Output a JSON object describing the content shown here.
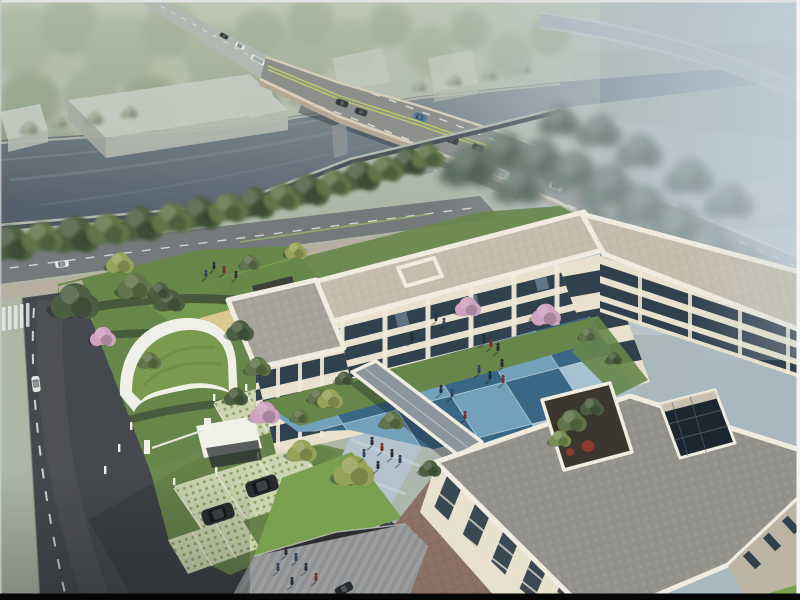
{
  "scene": {
    "type": "aerial-architectural-rendering",
    "description": "Bird's-eye architectural rendering: a three-storey cream courtyard building complex beside a canal, a curved highway bridge crossing the canal through hazy woodland, landscaped gardens with blossom trees, a blue checkerboard courtyard plaza with people, a green-roofed gatehouse, grass-grid parking with SUVs, a striped pedestrian plaza and a roof garden with an atrium skylight.",
    "elements": [
      {
        "name": "misty-woodland",
        "label": "Hazy woodland and meadows beyond the canal"
      },
      {
        "name": "canal",
        "label": "Dark canal water crossing the upper scene"
      },
      {
        "name": "highway-bridge",
        "label": "Curved multi-lane highway bridge with traffic"
      },
      {
        "name": "warehouse-sheds",
        "label": "Grey industrial sheds on the far bank"
      },
      {
        "name": "riverside-tree-row",
        "label": "Row of trees along the near bank"
      },
      {
        "name": "frontage-road",
        "label": "Riverside frontage road"
      },
      {
        "name": "city-street",
        "label": "Dark asphalt street with dashed centerline and crosswalk"
      },
      {
        "name": "gatehouse",
        "label": "Curved green-roof gatehouse at the site entrance"
      },
      {
        "name": "grass-grid-parking",
        "label": "Permeable grass-grid parking bays with SUVs"
      },
      {
        "name": "courtyard-building",
        "label": "Three-storey cream building wrapping the courtyard"
      },
      {
        "name": "checkerboard-courtyard",
        "label": "Blue checkerboard courtyard plaza with pedestrians"
      },
      {
        "name": "covered-walkway",
        "label": "Covered link walkway across the courtyard"
      },
      {
        "name": "front-building",
        "label": "Front building with large grey paver roof"
      },
      {
        "name": "roof-garden",
        "label": "Planted roof garden with red shrubs"
      },
      {
        "name": "atrium-skylight",
        "label": "Glazed atrium opening in the roof"
      },
      {
        "name": "pedestrian-plaza",
        "label": "Striped grey pedestrian plaza with people"
      },
      {
        "name": "terrace",
        "label": "Reddish-brown paved terrace by the front facade"
      }
    ]
  },
  "objects": {
    "vehicles": {
      "bridge_cars": 7,
      "bridge_bus": 1,
      "bridge_van": 1,
      "distant_vehicles": 3,
      "street_van": 1,
      "frontage_cars": 2,
      "parked_suvs": 2,
      "entry_car": 1
    },
    "people_groups": {
      "courtyard": 11,
      "plaza": 6,
      "walkway_path": 6,
      "north_lawn": 4,
      "courtyard_grass": 2
    }
  },
  "colors": {
    "bgA": "#adb7a6",
    "bgB": "#a9b8bf",
    "forest1": "#93a289",
    "forest2": "#86977c",
    "forest3": "#9dab92",
    "meadow": "#a4ae92",
    "fieldFar": "#9dab9f",
    "water1": "#525f6c",
    "water2": "#5e6c7b",
    "water3": "#8a9aa8",
    "waterStreak": "#6f7f8e",
    "bankFar": "#a6aaa0",
    "bankNearTop": "#b4bab0",
    "bankNearFace": "#49525a",
    "box1": "#c6cac3",
    "box2": "#b0b4ad",
    "box3": "#9da19b",
    "roadDistant": "#b3b7b1",
    "ramp": "#a6b2b8",
    "rampLight": "#c4cdd2",
    "deck": "#8d8f8c",
    "parapetBridge": "#d6cdb8",
    "girder": "#b3a794",
    "bridgeShadow": "#39424c",
    "lane": "#e9ebe8",
    "median": "#c0cc68",
    "pierBridge": "#8e9494",
    "treeDark": "#4c5e41",
    "treeMid": "#61744a",
    "treeLight": "#7b8f55",
    "treeHaze": "#56685a",
    "treePale": "#8c9c86",
    "treeYellow": "#97a258",
    "blossom": "#cfa2c1",
    "roadFront": "#75797b",
    "sidewalk": "#b6afa0",
    "grass": "#67864a",
    "grassBright": "#79a04f",
    "hedge": "#41533a",
    "sand": "#d9c98f",
    "pergola": "#3c4139",
    "street": "#45484c",
    "streetLight": "#585c5f",
    "driveway": "#3c4044",
    "plaza": "#8f9192",
    "pathBlue": "#b3c2cc",
    "pathStripe": "#c9d5db",
    "terrace": "#8b7264",
    "latBase": "#ccd4b0",
    "latDot": "#879c5c",
    "facade": "#e7e1cd",
    "facadeShade": "#bcb4a3",
    "pierCol": "#f0ead9",
    "glass": "#31404d",
    "glassLight": "#8fa9ba",
    "roofA": "#a5a29a",
    "roofCream": "#c4bdac",
    "roofB": "#92918b",
    "parapet": "#f0ece0",
    "tileLight": "#73a1bb",
    "tileDark": "#3a6785",
    "tilePale": "#a6c1cf",
    "tileLine": "#d5e3ea",
    "walkRoof": "#8d959c",
    "gateGreen": "#7a9a4f",
    "gateGreenDark": "#6b8a43",
    "gateWhite": "#eff0e7",
    "atriumGlass": "#1b2630",
    "atriumWall": "#d9d2bd",
    "soil": "#3c372e",
    "shrubRed": "#8f3a2e",
    "suv": "#282c2f",
    "carDark": "#3a4045",
    "carWhite": "#e3e5e2",
    "carBlue": "#4f7ba3",
    "carRed": "#9c2d22",
    "busBody": "#dfe3e1",
    "person": "#262c34",
    "personRed": "#7a2d28",
    "personBlue": "#32415c",
    "shadow": "rgba(22,28,34,0.35)",
    "mist": "#c2d0da",
    "hazeGreen": "#c6cdbb",
    "frameTop": "#e2e2e2",
    "frameSide": "#f4f4f4",
    "frameLeft": "#cccccc",
    "frameBottom": "#060606"
  }
}
